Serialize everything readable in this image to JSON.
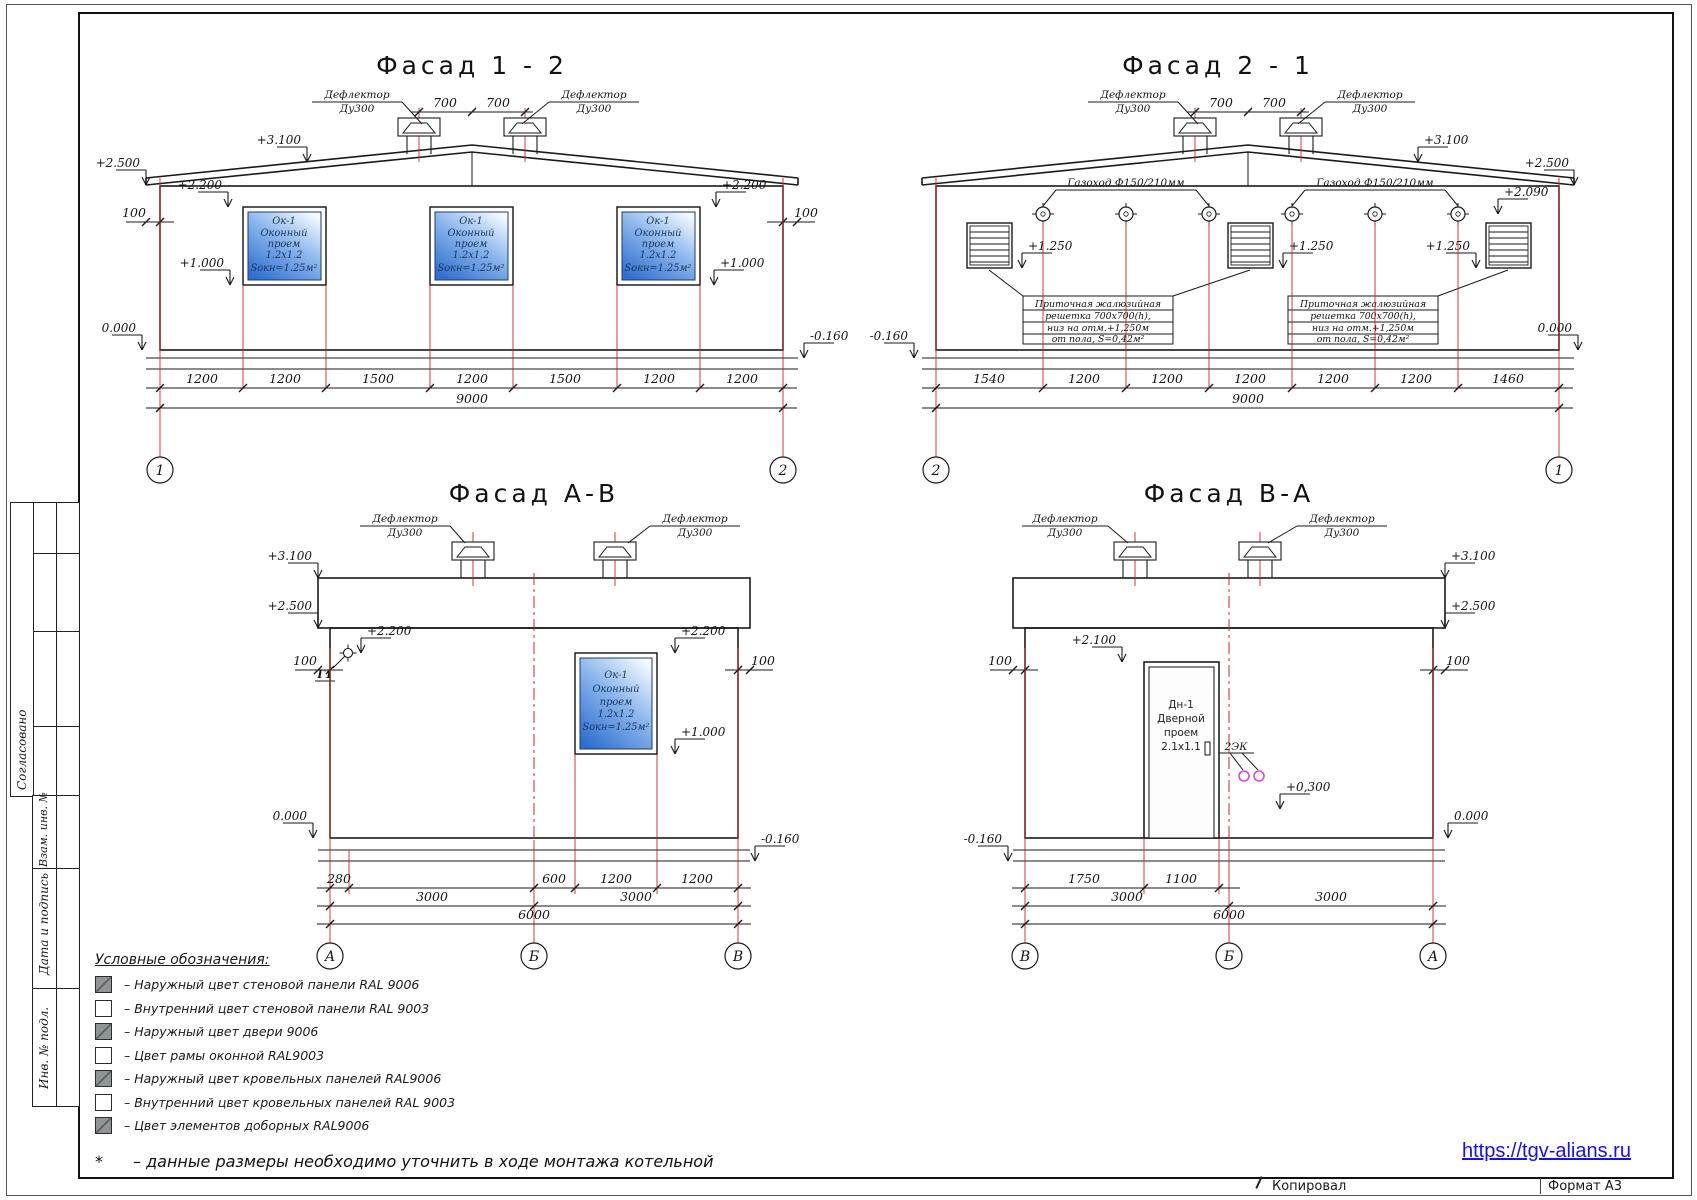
{
  "titles": {
    "f12": "Фасад  1 - 2",
    "f21": "Фасад  2 - 1",
    "fab": "Фасад  А-В",
    "fba": "Фасад  В-А"
  },
  "deflector": {
    "l1": "Дефлектор",
    "l2": "Ду300"
  },
  "window": {
    "l1": "Ок-1",
    "l2": "Оконный",
    "l3": "проем",
    "l4": "1.2х1.2",
    "l5": "Sокн=1.25м²"
  },
  "door": {
    "l1": "Дн-1",
    "l2": "Дверной",
    "l3": "проем",
    "l4": "2.1х1.1"
  },
  "gas_duct": "Газоход Ф150/210мм",
  "grille_note": {
    "l1": "Приточная жалюзийная",
    "l2": "решетка 700х700(h),",
    "l3": "низ на отм.+1,250м",
    "l4": "от пола, S=0,42м²"
  },
  "marks": {
    "p3100": "+3.100",
    "p2500": "+2.500",
    "p2200": "+2.200",
    "p2100": "+2.100",
    "p2090": "+2.090",
    "p1250": "+1.250",
    "p1000": "+1.000",
    "p0300": "+0,300",
    "zero": "0.000",
    "m0160": "-0.160",
    "h100": "100",
    "d700": "700",
    "g1": "Г1",
    "ek": "2ЭК"
  },
  "dims": {
    "f12": [
      "1200",
      "1200",
      "1500",
      "1200",
      "1500",
      "1200",
      "1200"
    ],
    "f12_total": "9000",
    "f21": [
      "1540",
      "1200",
      "1200",
      "1200",
      "1200",
      "1200",
      "1460"
    ],
    "f21_total": "9000",
    "fab_r1": [
      "280",
      "600",
      "1200",
      "1200"
    ],
    "fab_r2": [
      "3000",
      "3000"
    ],
    "fab_total": "6000",
    "fba_r1": [
      "1750",
      "1100"
    ],
    "fba_r2": [
      "3000",
      "3000"
    ],
    "fba_total": "6000"
  },
  "axes": {
    "n1": "1",
    "n2": "2",
    "a": "А",
    "b": "Б",
    "v": "В"
  },
  "legend": {
    "title": "Условные обозначения:",
    "items": [
      {
        "swatch": "gray",
        "text": "– Наружный цвет стеновой панели RAL 9006"
      },
      {
        "swatch": "white",
        "text": "– Внутренний цвет стеновой панели RAL 9003"
      },
      {
        "swatch": "gray",
        "text": "– Наружный цвет двери 9006"
      },
      {
        "swatch": "white",
        "text": "– Цвет рамы оконной RAL9003"
      },
      {
        "swatch": "gray",
        "text": "– Наружный цвет кровельных панелей  RAL9006"
      },
      {
        "swatch": "white",
        "text": "– Внутренний цвет кровельных панелей RAL 9003"
      },
      {
        "swatch": "gray",
        "text": "– Цвет элементов доборных RAL9006"
      }
    ],
    "star": "*",
    "footnote": "– данные размеры необходимо уточнить в ходе монтажа котельной"
  },
  "titleblock": {
    "soglasovano": "Согласовано",
    "vzam": "Взам. инв. №",
    "data_podpis": "Дата и подпись",
    "inv_podl": "Инв. № подл."
  },
  "footer": {
    "link": "https://tgv-alians.ru",
    "kopiroval": "Копировал",
    "format": "Формат А3"
  },
  "colors": {
    "accent_red": "#c62828",
    "window_blue": "#2f6fce",
    "link_blue": "#1612e0",
    "swatch_gray": "#8f9496"
  }
}
